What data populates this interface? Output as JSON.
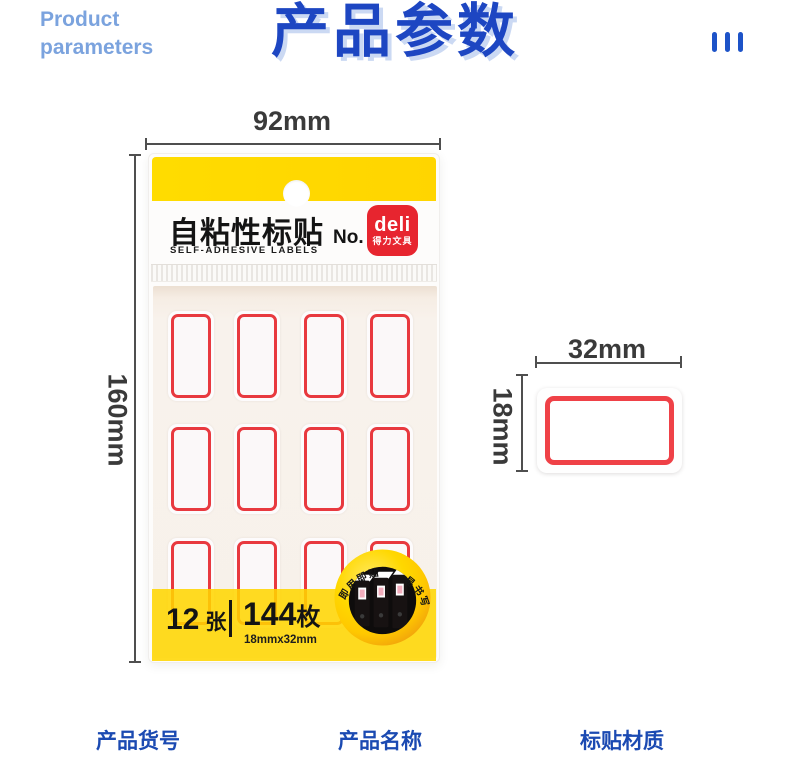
{
  "header": {
    "eyebrow_line1": "Product",
    "eyebrow_line2": "parameters",
    "title": "产品参数"
  },
  "annotations": {
    "package_width": "92mm",
    "package_height": "160mm",
    "label_width": "32mm",
    "label_height": "18mm"
  },
  "package": {
    "product_title": "自粘性标贴",
    "model_no": "No. 7184",
    "product_subtitle": "SELF-ADHESIVE LABELS",
    "brand_name": "deli",
    "brand_name_cn": "得力文具",
    "sheets_count": "12",
    "sheets_unit": "张",
    "pieces_count": "144",
    "pieces_unit": "枚",
    "label_size": "18mmx32mm",
    "badge_text_left": "即用即贴",
    "badge_text_right": "易书写",
    "grid": {
      "rows": 3,
      "cols": 4
    }
  },
  "colors": {
    "title_blue": "#1d46c2",
    "title_shadow_blue": "#cbd9f3",
    "eyebrow_blue": "#7ba3de",
    "footer_blue": "#1b4ab2",
    "accent_yellow": "#ffd900",
    "label_border_red": "#e8393f",
    "brand_red": "#e7252f"
  },
  "footer": {
    "items": [
      {
        "label": "产品货号"
      },
      {
        "label": "产品名称"
      },
      {
        "label": "标贴材质"
      }
    ]
  }
}
